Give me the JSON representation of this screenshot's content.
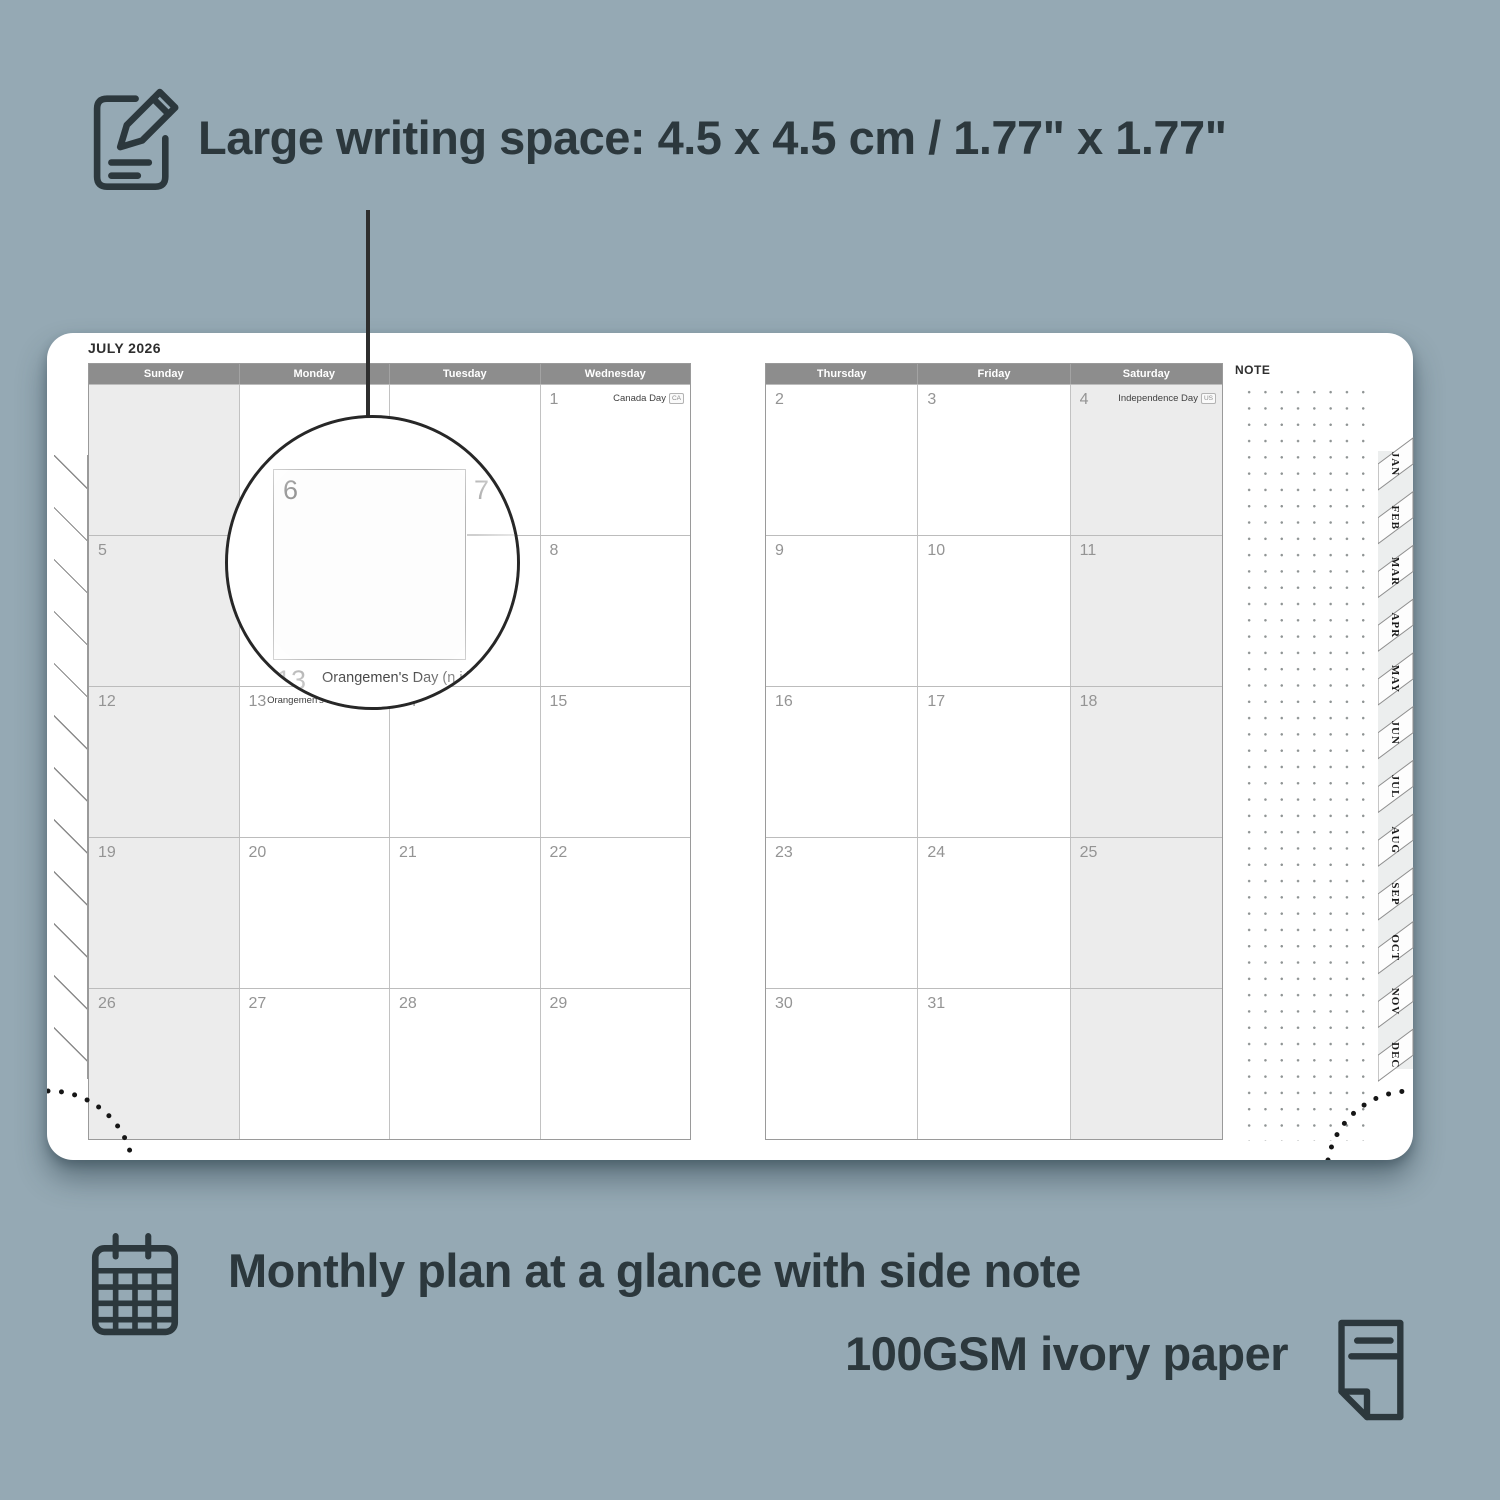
{
  "colors": {
    "background": "#95a9b4",
    "ink": "#2c383d",
    "page": "#ffffff",
    "header_bg": "#8d8d8d",
    "header_text": "#ffffff",
    "shaded_cell": "#ececec",
    "day_number": "#949494",
    "grid_line": "#c2c2c2"
  },
  "captions": {
    "top": "Large writing space: 4.5 x 4.5 cm / 1.77\" x 1.77\"",
    "bottom_line1": "Monthly plan at a glance with side note",
    "bottom_line2": "100GSM ivory paper"
  },
  "planner": {
    "title": "JULY 2026",
    "note_label": "NOTE",
    "month_tabs": [
      "JAN",
      "FEB",
      "MAR",
      "APR",
      "MAY",
      "JUN",
      "JUL",
      "AUG",
      "SEP",
      "OCT",
      "NOV",
      "DEC"
    ],
    "left_page": {
      "weekdays": [
        "Sunday",
        "Monday",
        "Tuesday",
        "Wednesday"
      ],
      "shaded_column": 0,
      "rows": [
        [
          {
            "day": ""
          },
          {
            "day": ""
          },
          {
            "day": ""
          },
          {
            "day": "1",
            "holiday": "Canada Day",
            "flag": "CA"
          }
        ],
        [
          {
            "day": "5"
          },
          {
            "day": "6"
          },
          {
            "day": "7"
          },
          {
            "day": "8"
          }
        ],
        [
          {
            "day": "12"
          },
          {
            "day": "13",
            "holiday": "Orangemen's Day (n.i.)",
            "flag": "UK"
          },
          {
            "day": "14"
          },
          {
            "day": "15"
          }
        ],
        [
          {
            "day": "19"
          },
          {
            "day": "20"
          },
          {
            "day": "21"
          },
          {
            "day": "22"
          }
        ],
        [
          {
            "day": "26"
          },
          {
            "day": "27"
          },
          {
            "day": "28"
          },
          {
            "day": "29"
          }
        ]
      ]
    },
    "right_page": {
      "weekdays": [
        "Thursday",
        "Friday",
        "Saturday"
      ],
      "shaded_column": 2,
      "rows": [
        [
          {
            "day": "2"
          },
          {
            "day": "3"
          },
          {
            "day": "4",
            "holiday": "Independence Day",
            "flag": "US"
          }
        ],
        [
          {
            "day": "9"
          },
          {
            "day": "10"
          },
          {
            "day": "11"
          }
        ],
        [
          {
            "day": "16"
          },
          {
            "day": "17"
          },
          {
            "day": "18"
          }
        ],
        [
          {
            "day": "23"
          },
          {
            "day": "24"
          },
          {
            "day": "25"
          }
        ],
        [
          {
            "day": "30"
          },
          {
            "day": "31"
          },
          {
            "day": ""
          }
        ]
      ]
    }
  },
  "magnifier": {
    "day": "6",
    "adjacent_day": "7",
    "bottom_day": "13",
    "holiday": "Orangemen's Day (n.i.)",
    "flag": "UK"
  }
}
